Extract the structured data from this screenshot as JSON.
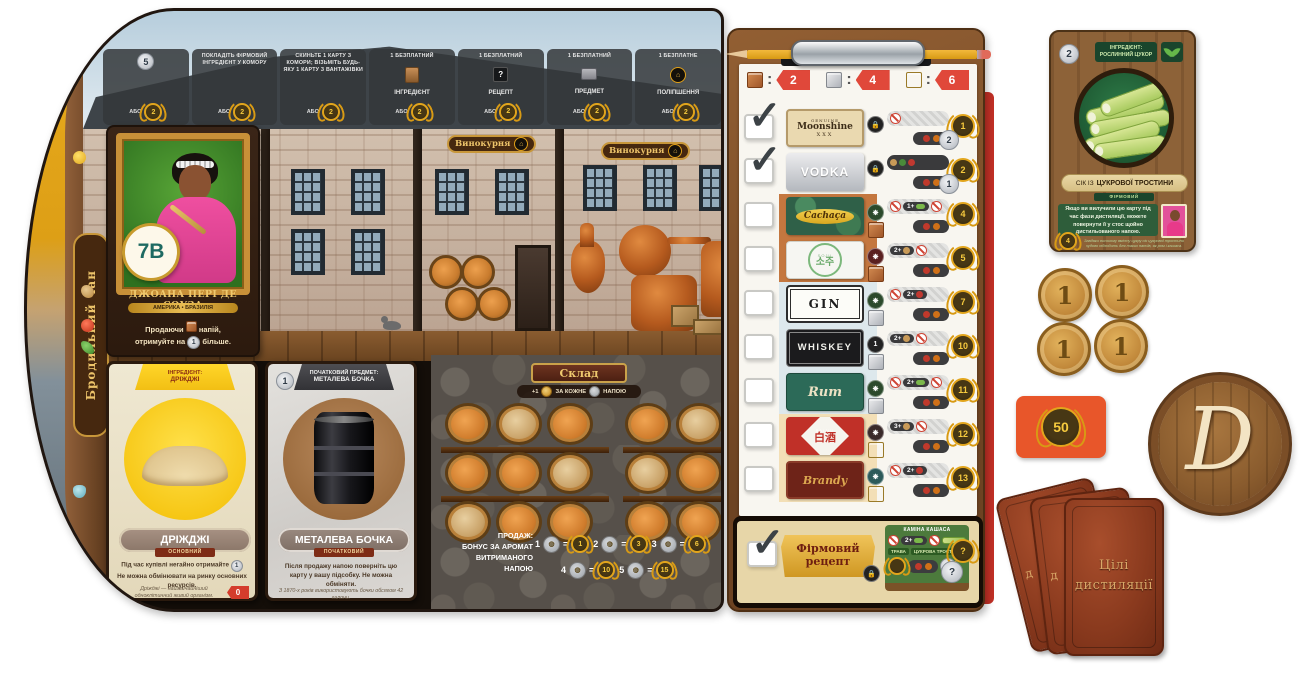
{
  "board": {
    "vat_label": "Бродильний чан",
    "distillery_sign": "Винокурня",
    "top_actions": [
      {
        "value": "5",
        "or": "АБО",
        "laurel": "2"
      },
      {
        "text": "ПОКЛАДІТЬ ФІРМОВИЙ ІНГРЕДІЄНТ У КОМОРУ",
        "or": "АБО",
        "laurel": "2"
      },
      {
        "text": "СКИНЬТЕ 1 КАРТУ З КОМОРИ; ВІЗЬМІТЬ БУДЬ-ЯКУ 1 КАРТУ З ВАНТАЖІВКИ",
        "or": "АБО",
        "laurel": "2"
      },
      {
        "top": "1 БЕЗПЛАТНИЙ",
        "label": "ІНГРЕДІЄНТ",
        "or": "АБО",
        "laurel": "2"
      },
      {
        "top": "1 БЕЗПЛАТНИЙ",
        "label": "РЕЦЕПТ",
        "tile": "?",
        "or": "АБО",
        "laurel": "2"
      },
      {
        "top": "1 БЕЗПЛАТНИЙ",
        "label": "ПРЕДМЕТ",
        "or": "АБО",
        "laurel": "2"
      },
      {
        "top": "1 БЕЗПЛАТНЕ",
        "label": "ПОЛІПШЕННЯ",
        "or": "АБО",
        "laurel": "2"
      }
    ],
    "character_card": {
      "badge": "7B",
      "name": "ДЖОАНА ПЕРІ ДЕ СОУЗА",
      "region": "АМЕРИКА • БРАЗИЛІЯ",
      "ability_1": "Продаючи",
      "ability_2": "напій,",
      "ability_3": "отримуйте на",
      "ability_coin": "1",
      "ability_4": "більше."
    },
    "yeast_card": {
      "header_top": "ІНГРЕДІЄНТ:",
      "header": "ДРІЖДЖІ",
      "title": "ДРІЖДЖІ",
      "subtitle": "ОСНОВНИЙ",
      "rule_1": "Під час купівлі негайно отримайте",
      "rule_coin": "1",
      "rule_2": "Не можна обмінювати на ринку основних ресурсів.",
      "flavor": "Дріжджі — найзвичайніший одноклітинний живий організм.",
      "price": "0"
    },
    "barrel_card": {
      "header_top": "ПОЧАТКОВИЙ ПРЕДМЕТ:",
      "header": "МЕТАЛЕВА БОЧКА",
      "coin": "1",
      "title": "МЕТАЛЕВА БОЧКА",
      "subtitle": "ПОЧАТКОВИЙ",
      "rule": "Після продажу напою поверніть цю карту у вашу підсобку. Не можна обміняти.",
      "flavor": "З 1870-х років використовують бочки обсягом 42 галони."
    },
    "warehouse": {
      "sign": "Склад",
      "bonus_plus": "+1",
      "bonus_mid": "ЗА КОЖНЕ",
      "bonus_end": "НАПОЮ",
      "sale_1": "ПРОДАЖ:",
      "sale_2": "БОНУС ЗА АРОМАТ",
      "sale_3": "ВИТРИМАНОГО",
      "sale_4": "НАПОЮ",
      "aroma_bonuses": [
        {
          "count": "1",
          "laurel": "1"
        },
        {
          "count": "2",
          "laurel": "3"
        },
        {
          "count": "3",
          "laurel": "6"
        },
        {
          "count": "4",
          "laurel": "10"
        },
        {
          "count": "5",
          "laurel": "15"
        }
      ]
    }
  },
  "clipboard": {
    "costs": [
      {
        "cube": "brown-cube",
        "value": "2"
      },
      {
        "cube": "silver-cube",
        "value": "4"
      },
      {
        "cube": "gold-cube",
        "value": "6"
      }
    ],
    "spirits": [
      {
        "name": "Moonshine",
        "brand_top": "GENUINE",
        "brand_bottom": "XXX",
        "checked": true,
        "laurel": "1",
        "coin": "2"
      },
      {
        "name": "VODKA",
        "checked": true,
        "laurel": "2",
        "coin": "1"
      },
      {
        "name": "Cachaça",
        "checked": false,
        "laurel": "4",
        "req": "1+"
      },
      {
        "name": "소주",
        "brand_top": "SOJU",
        "checked": false,
        "laurel": "5",
        "req": "2+"
      },
      {
        "name": "GIN",
        "checked": false,
        "laurel": "7",
        "req": "2+"
      },
      {
        "name": "WHISKEY",
        "checked": false,
        "laurel": "10",
        "req": "2+",
        "icon_value": "1"
      },
      {
        "name": "Rum",
        "checked": false,
        "laurel": "11",
        "req": "2+"
      },
      {
        "name": "白酒",
        "brand_top": "BAIJIU",
        "checked": false,
        "laurel": "12",
        "req": "3+"
      },
      {
        "name": "Brandy",
        "checked": false,
        "laurel": "13",
        "req": "2+"
      }
    ],
    "signature": {
      "plaque_1": "Фірмовий",
      "plaque_2": "рецепт",
      "recipe_name": "КАМІНА КАШАСА",
      "req": "2+",
      "tag_grass": "ТРАВА",
      "tag_cane": "ЦУКРОВА ТРОСТИНА",
      "coin": "1",
      "laurel_unknown": "?",
      "coin_unknown": "?"
    }
  },
  "right_area": {
    "sugarcane_card": {
      "coin": "2",
      "header_1": "ІНГРЕДІЄНТ:",
      "header_2": "РОСЛИННИЙ ЦУКОР",
      "title_pre": "СІК ІЗ",
      "title_main": "ЦУКРОВОЇ ТРОСТИНИ",
      "subtitle": "ФІРМОВИЙ",
      "rule": "Якщо ви вилучили цю карту під час фази дистиляції, можете повернути її у стос щойно дистильованого напою.",
      "laurel": "4",
      "flavor": "Завдяки високому вмісту цукру сік цукрової тростини чудово підходить для таких напоїв, як ром і кашаса."
    },
    "coin_value": "1",
    "score_card_value": "50",
    "logo_letter": "D",
    "goal_title_1": "Цілі",
    "goal_title_2": "дистиляції",
    "goal_back_letter": "д"
  }
}
